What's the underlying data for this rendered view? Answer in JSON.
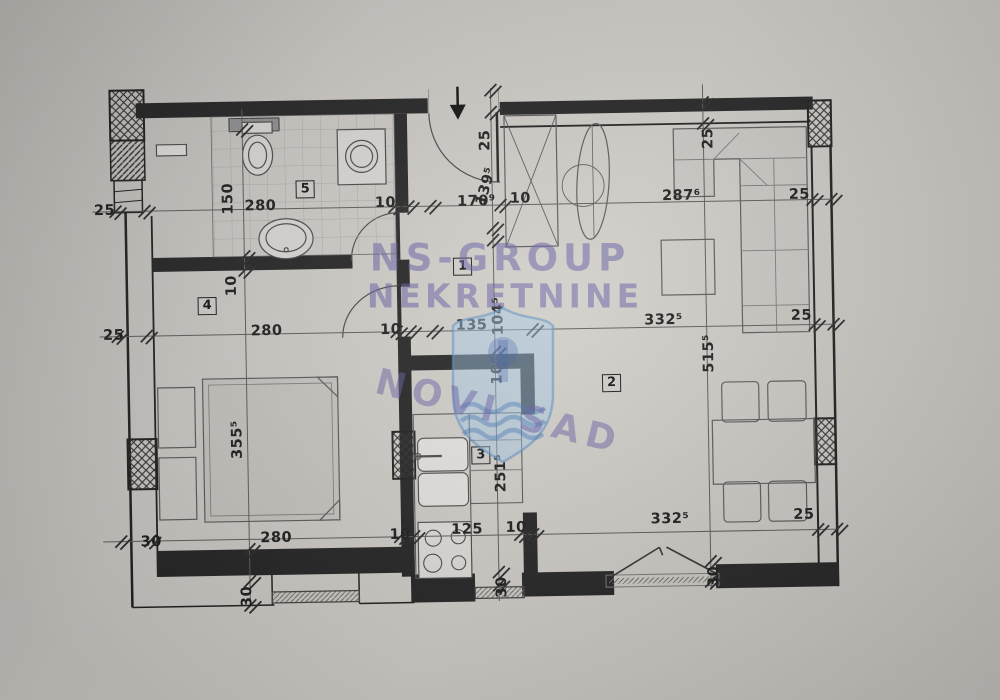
{
  "watermark": {
    "line1": "NS-GROUP",
    "line2": "NEKRETNINE",
    "stamp": "NOVI SAD"
  },
  "rooms": {
    "hall": "1",
    "living": "2",
    "kitchen": "3",
    "bedroom": "4",
    "bathroom": "5"
  },
  "dims": {
    "top_left_25": "25",
    "top_150": "150",
    "top_280": "280",
    "top_10_a": "10",
    "top_170": "170⁹",
    "top_139": "139⁵",
    "top_10_b": "10",
    "top_287": "287⁶",
    "top_right_25": "25",
    "entry_25": "25",
    "living_top_25": "25",
    "mid_left_25": "25",
    "wall_10": "10",
    "mid_280": "280",
    "mid_10": "10",
    "mid_135": "135",
    "mid_104": "104⁵",
    "mid_332": "332⁵",
    "mid_right_25": "25",
    "kit_10": "10",
    "kit_251": "251⁵",
    "bot_30": "30",
    "bot_280": "280",
    "bot_10_a": "10",
    "bot_125": "125",
    "bot_10_b": "10",
    "bot_332": "332⁵",
    "bot_right_25": "25",
    "v30_bed": "30",
    "v30_kit": "30",
    "v30_balc": "30",
    "bed_355": "355⁵",
    "living_515": "515⁵"
  },
  "colors": {
    "wall": "#242424",
    "watermark_purple": "#655ca2",
    "shield_blue": "#a0c8e8"
  }
}
